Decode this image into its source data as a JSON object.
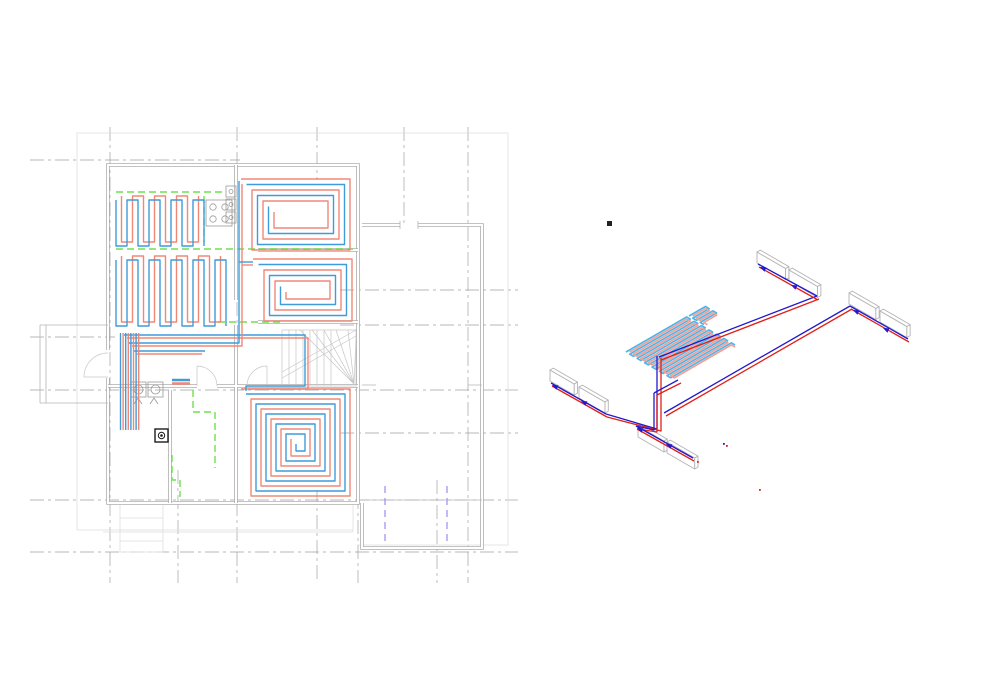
{
  "colors": {
    "plan_red": "#f08878",
    "plan_blue": "#3f9cd9",
    "coil_red": "#f59d95",
    "coil_blue": "#49b5e9",
    "axon_red": "#e02118",
    "axon_blue": "#2219cc",
    "zone_green": "#6fe04e",
    "opening_violet": "#9b8cf2",
    "wall_gray": "#aeaeae",
    "grid_gray": "#a0a0a0"
  },
  "plan_view": {
    "heating_circuits": [
      {
        "id": "serpentine-field-1",
        "type": "serpentine",
        "x": 116,
        "y": 196,
        "w": 92,
        "h": 50,
        "pitch": 11
      },
      {
        "id": "serpentine-field-2",
        "type": "serpentine",
        "x": 116,
        "y": 256,
        "w": 112,
        "h": 70,
        "pitch": 11
      },
      {
        "id": "spiral-room-top",
        "type": "spiral",
        "x": 241,
        "y": 179,
        "w": 109,
        "h": 71,
        "gap": 5.5
      },
      {
        "id": "spiral-room-mid",
        "type": "spiral",
        "x": 253,
        "y": 259,
        "w": 99,
        "h": 62,
        "gap": 5.5
      },
      {
        "id": "spiral-room-bottom",
        "type": "spiral",
        "x": 241,
        "y": 389,
        "w": 109,
        "h": 107,
        "gap": 5
      }
    ],
    "pipe_runs": [
      {
        "color": "blue",
        "pts": [
          [
            124,
            335
          ],
          [
            305,
            335
          ],
          [
            305,
            386
          ],
          [
            246,
            386
          ],
          [
            246,
            391
          ]
        ]
      },
      {
        "color": "red",
        "pts": [
          [
            127,
            338
          ],
          [
            308,
            338
          ],
          [
            308,
            389
          ],
          [
            248,
            389
          ]
        ]
      },
      {
        "color": "blue",
        "pts": [
          [
            129,
            343
          ],
          [
            239,
            343
          ],
          [
            239,
            181
          ]
        ]
      },
      {
        "color": "red",
        "pts": [
          [
            132,
            346
          ],
          [
            242,
            346
          ],
          [
            242,
            184
          ]
        ]
      },
      {
        "color": "blue",
        "pts": [
          [
            239,
            262
          ],
          [
            253,
            262
          ]
        ]
      },
      {
        "color": "red",
        "pts": [
          [
            242,
            265
          ],
          [
            253,
            265
          ]
        ]
      },
      {
        "color": "blue",
        "pts": [
          [
            134,
            351
          ],
          [
            205,
            351
          ]
        ]
      },
      {
        "color": "red",
        "pts": [
          [
            137,
            354
          ],
          [
            202,
            354
          ]
        ]
      }
    ],
    "supply_bundle": {
      "x": 120.5,
      "spacing": 2.6,
      "count": 8,
      "y1": 333,
      "y2": 430
    },
    "radiator_symbol": {
      "x": 172,
      "y": 380,
      "w": 18
    },
    "floor_box_symbol": {
      "x": 155,
      "y": 429,
      "size": 13
    }
  },
  "axonometric_view": {
    "radiators": [
      {
        "x": 757,
        "y": 263,
        "len": 33
      },
      {
        "x": 789,
        "y": 281,
        "len": 33
      },
      {
        "x": 849,
        "y": 304,
        "len": 31
      },
      {
        "x": 880,
        "y": 322,
        "len": 31
      },
      {
        "x": 550,
        "y": 381,
        "len": 28
      },
      {
        "x": 579,
        "y": 398,
        "len": 30
      },
      {
        "x": 638,
        "y": 437,
        "len": 30
      },
      {
        "x": 667,
        "y": 453,
        "len": 32
      }
    ],
    "coil": {
      "origin": [
        626,
        352
      ],
      "teeth": 13,
      "pitch": 4.3,
      "len": 70,
      "appendix": {
        "origin": [
          689,
          316
        ],
        "teeth": 4,
        "pitch": 4.3,
        "len": 19
      }
    },
    "pipes": [
      {
        "color": "blue",
        "pts": [
          [
            659,
            357
          ],
          [
            817,
            296
          ]
        ]
      },
      {
        "color": "red",
        "pts": [
          [
            661,
            360
          ],
          [
            819,
            299
          ]
        ]
      },
      {
        "color": "blue",
        "pts": [
          [
            758,
            264
          ],
          [
            817,
            296
          ]
        ]
      },
      {
        "color": "red",
        "pts": [
          [
            759,
            267
          ],
          [
            818,
            300
          ]
        ]
      },
      {
        "color": "blue",
        "pts": [
          [
            850,
            306
          ],
          [
            908,
            339
          ]
        ]
      },
      {
        "color": "red",
        "pts": [
          [
            851,
            309
          ],
          [
            909,
            342
          ]
        ]
      },
      {
        "color": "blue",
        "pts": [
          [
            850,
            306
          ],
          [
            664,
            413
          ]
        ]
      },
      {
        "color": "red",
        "pts": [
          [
            852,
            309
          ],
          [
            666,
            416
          ]
        ]
      },
      {
        "color": "blue",
        "pts": [
          [
            657,
            356
          ],
          [
            657,
            429
          ],
          [
            606,
            414
          ]
        ]
      },
      {
        "color": "red",
        "pts": [
          [
            661,
            358
          ],
          [
            661,
            431
          ],
          [
            607,
            417
          ]
        ]
      },
      {
        "color": "blue",
        "pts": [
          [
            551,
            383
          ],
          [
            606,
            414
          ]
        ]
      },
      {
        "color": "red",
        "pts": [
          [
            552,
            386
          ],
          [
            607,
            417
          ]
        ]
      },
      {
        "color": "blue",
        "pts": [
          [
            654,
            393
          ],
          [
            678,
            380
          ]
        ]
      },
      {
        "color": "red",
        "pts": [
          [
            657,
            395
          ],
          [
            681,
            383
          ]
        ]
      },
      {
        "color": "blue",
        "pts": [
          [
            654,
            393
          ],
          [
            654,
            430
          ],
          [
            636,
            426
          ]
        ]
      },
      {
        "color": "red",
        "pts": [
          [
            657,
            395
          ],
          [
            657,
            432
          ],
          [
            638,
            429
          ]
        ]
      },
      {
        "color": "blue",
        "pts": [
          [
            636,
            426
          ],
          [
            693,
            458
          ]
        ]
      },
      {
        "color": "red",
        "pts": [
          [
            637,
            429
          ],
          [
            694,
            461
          ]
        ]
      }
    ],
    "flow_arrows": [
      {
        "x": 760,
        "y": 267,
        "a": 205
      },
      {
        "x": 791,
        "y": 285,
        "a": 205
      },
      {
        "x": 853,
        "y": 310,
        "a": 205
      },
      {
        "x": 883,
        "y": 328,
        "a": 205
      },
      {
        "x": 552,
        "y": 385,
        "a": 205
      },
      {
        "x": 581,
        "y": 401,
        "a": 205
      },
      {
        "x": 637,
        "y": 428,
        "a": 205
      },
      {
        "x": 666,
        "y": 444,
        "a": 205
      }
    ],
    "endpoint_dots": [
      {
        "x": 697,
        "y": 461,
        "color": "red"
      },
      {
        "x": 723,
        "y": 443,
        "color": "blue"
      },
      {
        "x": 726,
        "y": 445,
        "color": "red"
      },
      {
        "x": 759,
        "y": 489,
        "color": "red"
      }
    ],
    "junction_marker": {
      "x": 607,
      "y": 221,
      "size": 5
    }
  }
}
